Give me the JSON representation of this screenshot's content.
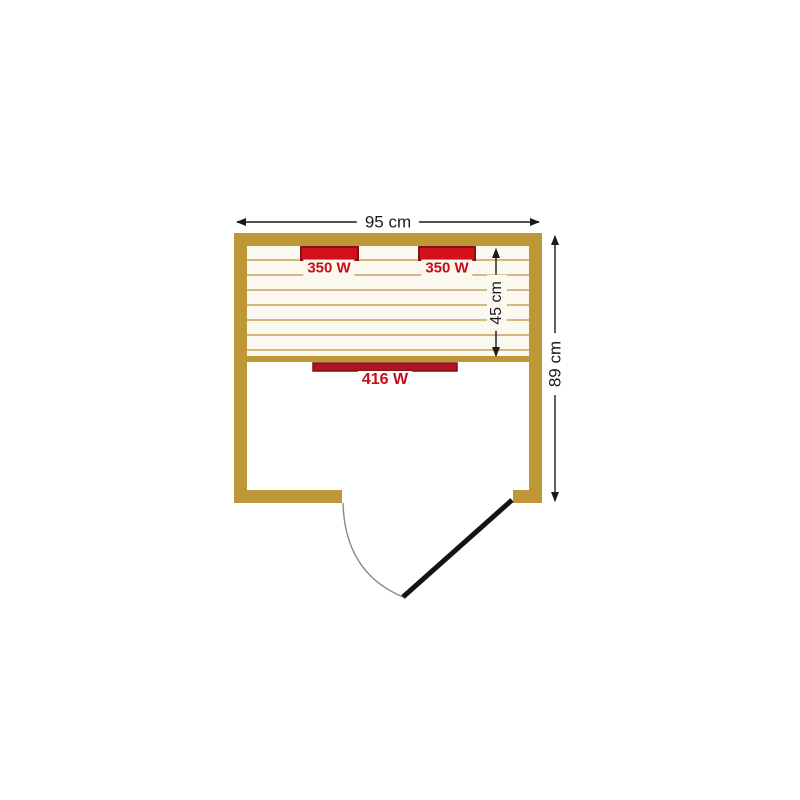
{
  "dimensions": {
    "width": "95 cm",
    "height": "89 cm",
    "bench_depth": "45 cm"
  },
  "heaters": {
    "top_left": "350 W",
    "top_right": "350 W",
    "front": "416 W"
  },
  "colors": {
    "wall": "#be9737",
    "slat_line": "#c8a35b",
    "bench_background": "#fbf8f0",
    "heater_fill": "#d4101c",
    "heater_front_fill": "#af1520",
    "heater_border": "#7c150f",
    "heater_label_red": "#c30d1a",
    "dimension_line": "#1a1a1a",
    "door_leaf": "#141414",
    "door_swing_arc": "#8a8a8a",
    "background": "#ffffff"
  }
}
